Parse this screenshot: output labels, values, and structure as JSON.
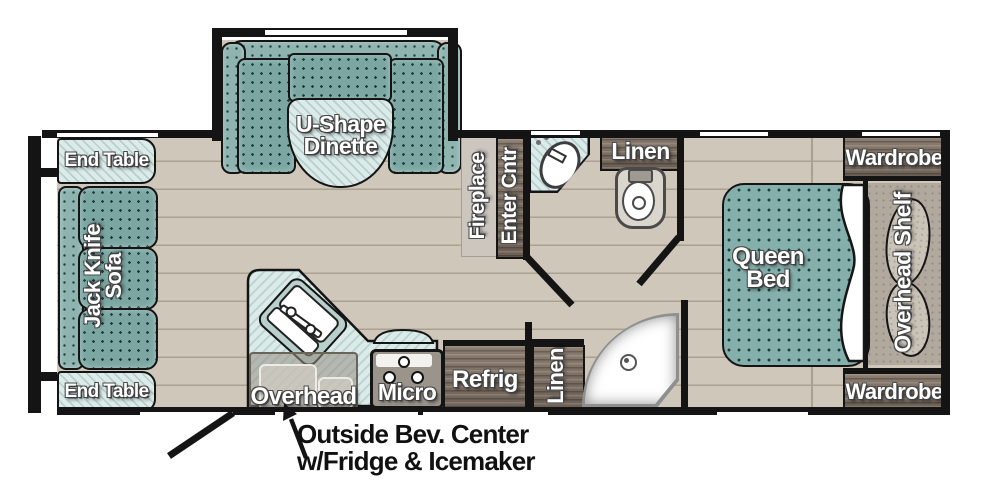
{
  "title": "Travel Trailer Floor Plan",
  "colors": {
    "wall": "#141414",
    "floor": "#cfc7ba",
    "cushion_teal": "#7ba6a2",
    "counter_aqua": "#dcebe9",
    "cabinet_wood": "#7c6f63",
    "platform_gray": "#b2a99e",
    "sheet_white": "#ffffff"
  },
  "areas": {
    "dinette": {
      "label": "U-Shape Dinette"
    },
    "living": {
      "end_table_front": "End Table",
      "sofa": "Jack Knife Sofa",
      "end_table_rear": "End Table"
    },
    "media_wall": {
      "fireplace": "Fireplace",
      "entertainment_center": "Enter Cntr"
    },
    "bathroom": {
      "linen": "Linen"
    },
    "kitchen": {
      "overhead": "Overhead",
      "microwave": "Micro",
      "refrigerator": "Refrig",
      "linen": "Linen"
    },
    "bedroom": {
      "bed": "Queen Bed",
      "shelf": "Overhead Shelf",
      "wardrobe_front": "Wardrobe",
      "wardrobe_rear": "Wardrobe"
    }
  },
  "annotation": {
    "line1": "Outside Bev. Center",
    "line2": "w/Fridge & Icemaker"
  }
}
